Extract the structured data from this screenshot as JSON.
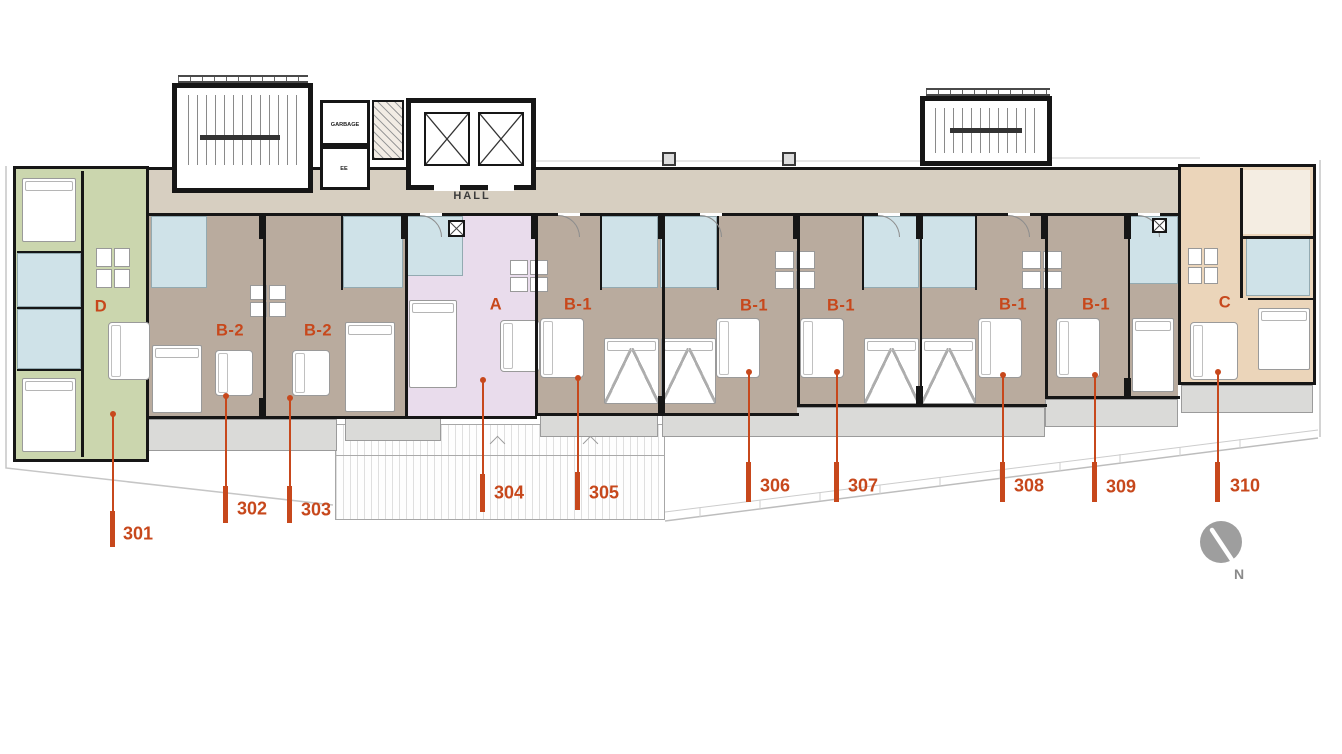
{
  "plan": {
    "labels": {
      "hall": "HALL",
      "garbage": "GARBAGE",
      "electrical": "EE",
      "north": "N"
    },
    "units": [
      {
        "type": "D",
        "number": "301"
      },
      {
        "type": "B-2",
        "number": "302"
      },
      {
        "type": "B-2",
        "number": "303"
      },
      {
        "type": "A",
        "number": "304"
      },
      {
        "type": "B-1",
        "number": "305"
      },
      {
        "type": "B-1",
        "number": "306"
      },
      {
        "type": "B-1",
        "number": "307"
      },
      {
        "type": "B-1",
        "number": "308"
      },
      {
        "type": "B-1",
        "number": "309"
      },
      {
        "type": "C",
        "number": "310"
      }
    ],
    "colors": {
      "accent": "#c7481c",
      "wall": "#161616",
      "hall": "#d7cfc1",
      "unitd": "#cbd6ae",
      "unitb": "#b9ab9e",
      "unita": "#e9dcec",
      "unitc": "#ebd5ba",
      "bath": "#cfe2e8",
      "balcony": "#dadad8",
      "compass": "#9e9e9e"
    }
  }
}
